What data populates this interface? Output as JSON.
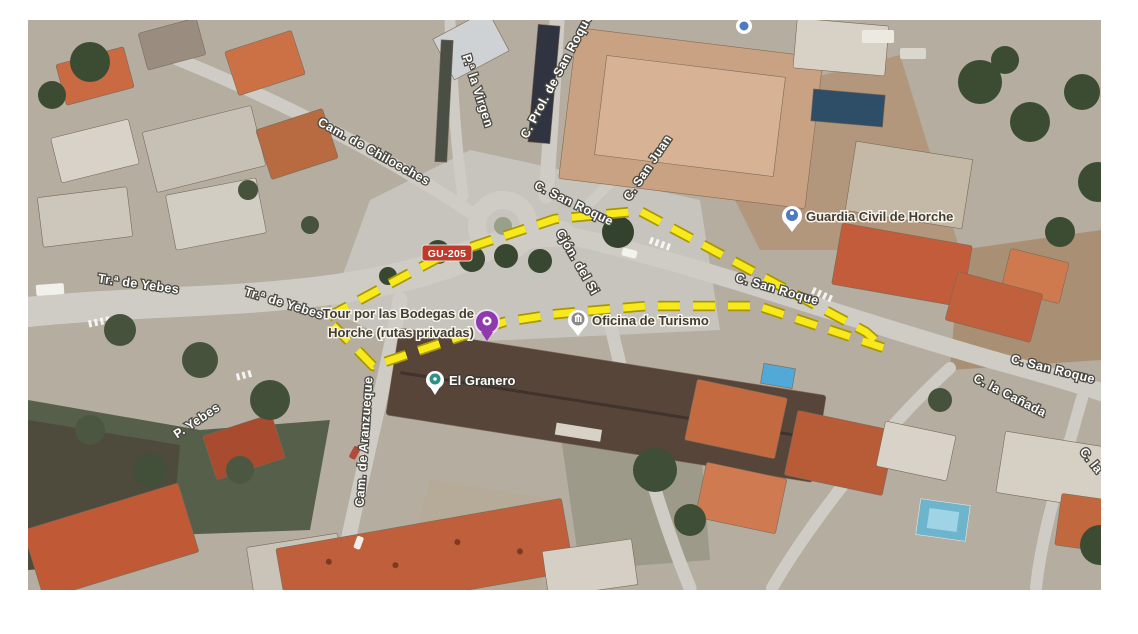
{
  "map": {
    "type": "satellite-imagery-with-annotation",
    "badge": {
      "text": "GU-205",
      "bg_color": "#bf3a2b"
    },
    "outline": {
      "style": "dashed",
      "color": "#f8e91c"
    },
    "roads": [
      {
        "text": "Cam. de Chiloeches"
      },
      {
        "text": "P.ª la Virgen"
      },
      {
        "text": "C. Prol. de San Roque"
      },
      {
        "text": "C. San Juan"
      },
      {
        "text": "C. San Roque"
      },
      {
        "text": "Cjón. del Si"
      },
      {
        "text": "C. San Roque"
      },
      {
        "text": "Tr.ª de Yebes"
      },
      {
        "text": "Tr.ª de Yebes"
      },
      {
        "text": "P. Yebes"
      },
      {
        "text": "Cam. de Aranzueque"
      },
      {
        "text": "C. San Roque"
      },
      {
        "text": "C. la Cañada"
      },
      {
        "text": "C. la"
      }
    ],
    "pois": [
      {
        "id": "guardia-civil",
        "label": "Guardia Civil de Horche"
      },
      {
        "id": "bodegas-tour",
        "line1": "Tour por las Bodegas de",
        "line2": "Horche (rutas privadas)"
      },
      {
        "id": "oficina-turismo",
        "label": "Oficina de Turismo"
      },
      {
        "id": "el-granero",
        "label": "El Granero"
      }
    ]
  }
}
